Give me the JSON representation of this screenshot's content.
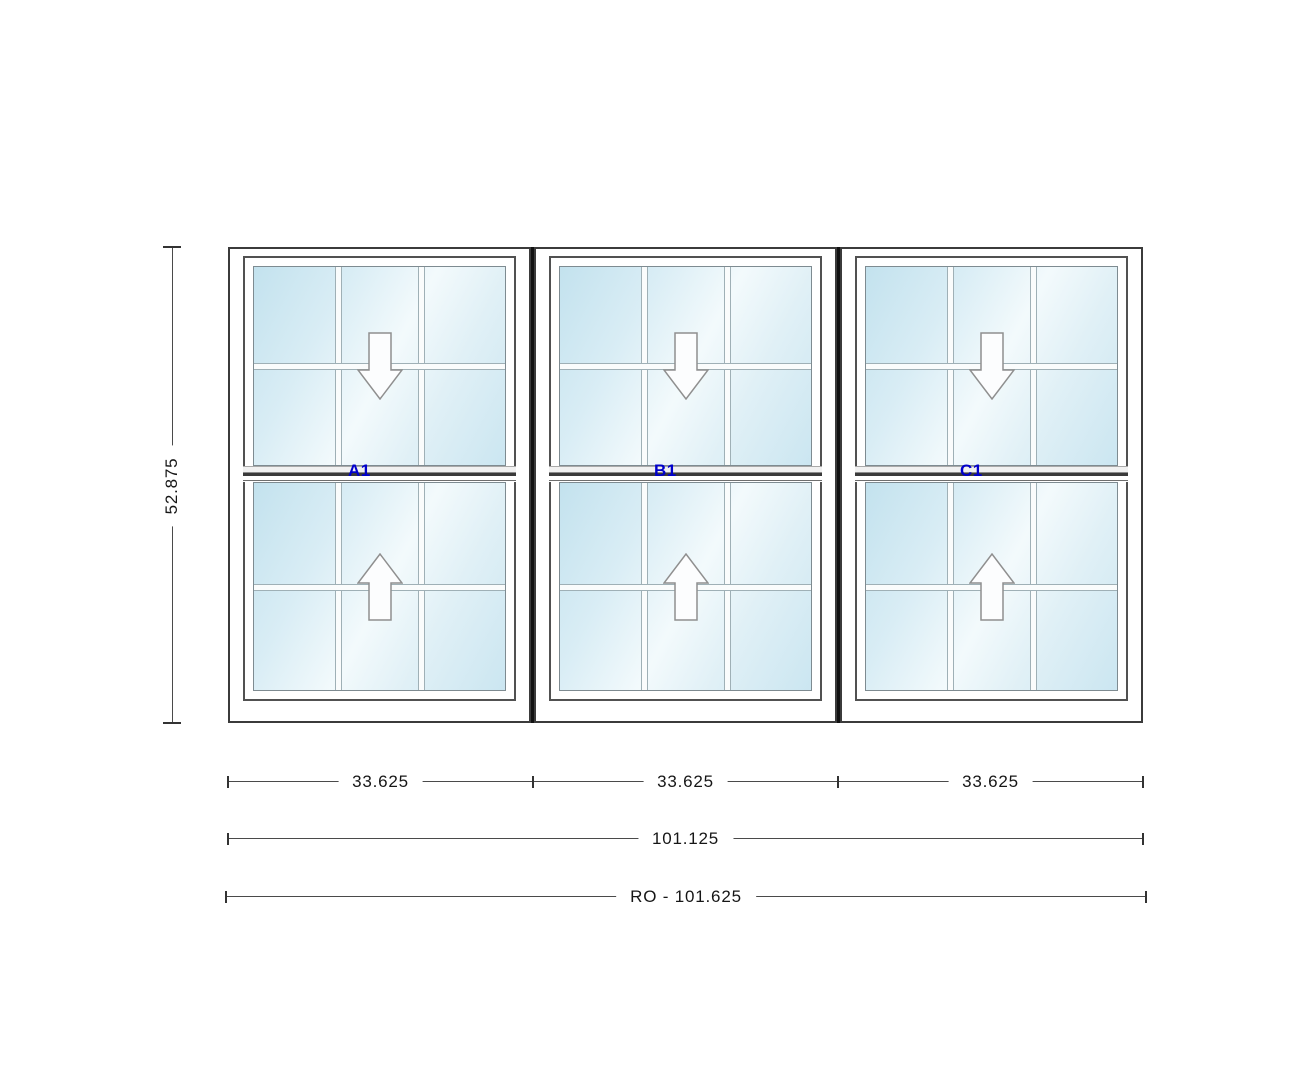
{
  "windows": [
    {
      "id": "A1",
      "label": "A1"
    },
    {
      "id": "B1",
      "label": "B1"
    },
    {
      "id": "C1",
      "label": "C1"
    }
  ],
  "dimensions": {
    "height": "52.875",
    "unit_widths": [
      "33.625",
      "33.625",
      "33.625"
    ],
    "total_width": "101.125",
    "rough_opening": "RO - 101.625"
  },
  "icons": {
    "upper_sash": "slide-down-arrow-icon",
    "lower_sash": "slide-up-arrow-icon"
  },
  "colors": {
    "label_blue": "#0000cc",
    "glass_blue": "#cde7f2",
    "frame_dark": "#3b3b3b",
    "mullion_black": "#121212",
    "dimension_line": "#4a4a4a"
  }
}
